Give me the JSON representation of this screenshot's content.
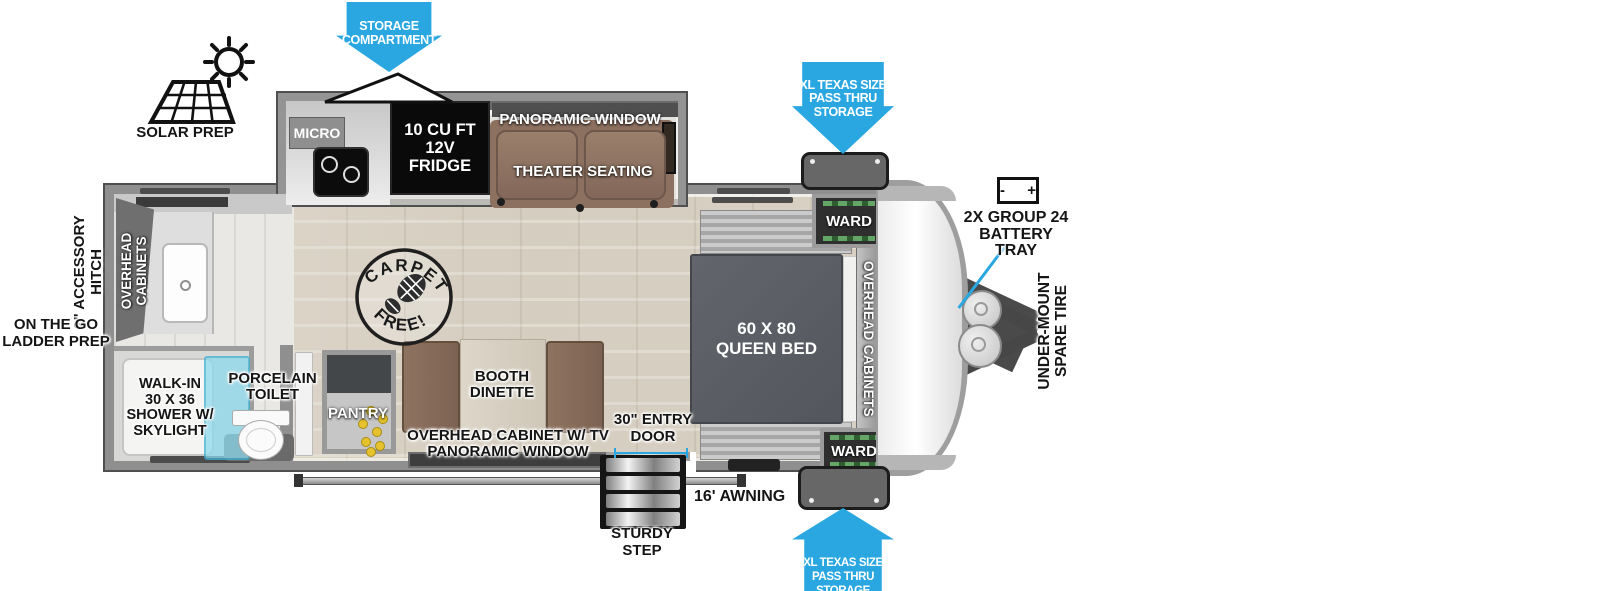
{
  "colors": {
    "arrow_blue": "#2aa7e1",
    "wall_gray": "#8f8f8f",
    "seat_brown": "#8c7060",
    "bed_gray": "#53575d",
    "shower_glass": "#8cd8ec",
    "pantry_yellow": "#e5c22e"
  },
  "labels": {
    "storage_compartment": "STORAGE\nCOMPARTMENT",
    "solar_prep": "SOLAR PREP",
    "micro": "MICRO",
    "fridge": "10 CU FT\n12V\nFRIDGE",
    "panoramic_window": "PANORAMIC WINDOW",
    "theater_seating": "THEATER SEATING",
    "pass_thru": "XL TEXAS SIZE\nPASS THRU\nSTORAGE",
    "ward": "WARD",
    "battery_symbols": "- +",
    "battery_tray": "2X GROUP 24\nBATTERY\nTRAY",
    "spare_tire": "UNDER-MOUNT\nSPARE TIRE",
    "queen_bed": "60 X 80\nQUEEN BED",
    "overhead_cabinets_front": "OVERHEAD CABINETS",
    "overhead_cabinets_rear": "OVERHEAD\nCABINETS",
    "accessory_hitch": "2\" ACCESSORY\nHITCH",
    "ladder_prep": "ON THE GO\nLADDER PREP",
    "shower": "WALK-IN\n30 X 36\nSHOWER W/\nSKYLIGHT",
    "toilet": "PORCELAIN\nTOILET",
    "pantry": "PANTRY",
    "booth_dinette": "BOOTH\nDINETTE",
    "tv_cabinet": "OVERHEAD CABINET W/ TV\nPANORAMIC WINDOW",
    "entry_door": "30\" ENTRY\nDOOR",
    "awning": "16' AWNING",
    "sturdy_step": "STURDY\nSTEP",
    "carpet_top": "CARPET",
    "carpet_bottom": "FREE!"
  }
}
